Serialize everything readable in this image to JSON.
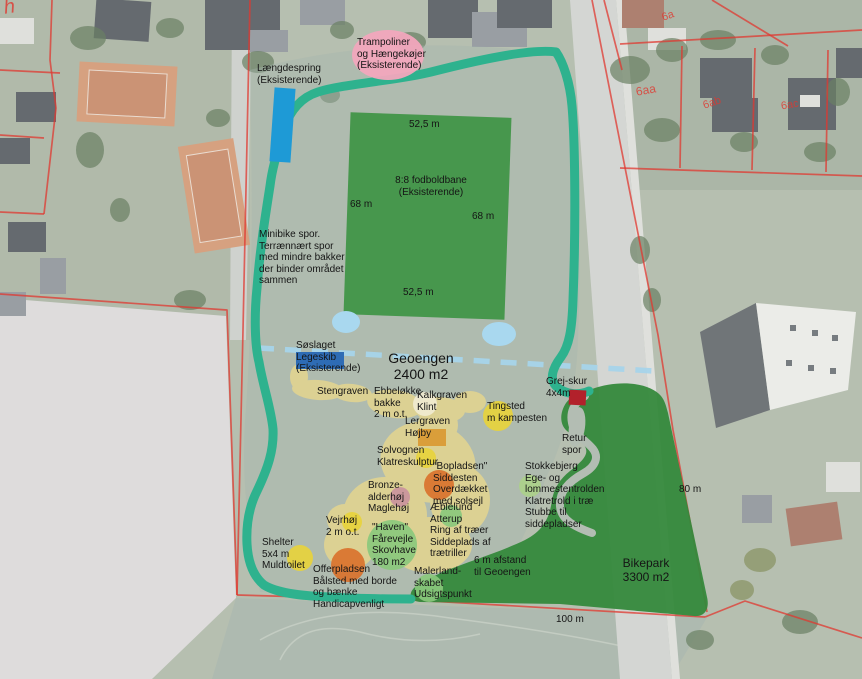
{
  "map_title": "Geoengen site plan (aerial overlay)",
  "colors": {
    "path_teal": "#2eb28e",
    "dashed_blue": "#a6d4ea",
    "sand_yellow": "#e5d58f",
    "pond_blue": "#a9d8ef",
    "field_green": "#3f9446",
    "bikepark_green": "#35893c",
    "circle_yellow": "#e7d33c",
    "circle_orange": "#d9722c",
    "circle_green": "#8ac87c",
    "circle_lightgreen": "#abd08a",
    "circle_pink": "#c9929c",
    "rect_orange": "#d99b35",
    "blue_light": "#1e9ad6",
    "blue_dark": "#2e6cb5",
    "blob_pink": "#f2a6bd",
    "shed_red": "#b2212b",
    "cadastral_red": "#e03830",
    "label_black": "#151515"
  },
  "map_labels": [
    {
      "name": "laengdespring",
      "text": "Længdespring\n(Eksisterende)",
      "x": 257,
      "y": 63
    },
    {
      "name": "trampoliner",
      "text": "Trampoliner\nog Hængekøjer\n(Eksisterende)",
      "x": 357,
      "y": 37
    },
    {
      "name": "field-width-top",
      "text": "52,5 m",
      "x": 409,
      "y": 119
    },
    {
      "name": "field-name",
      "text": "8:8 fodboldbane\n(Eksisterende)",
      "x": 431,
      "y": 175,
      "align": "center"
    },
    {
      "name": "field-side-left",
      "text": "68 m",
      "x": 350,
      "y": 199
    },
    {
      "name": "field-side-right",
      "text": "68 m",
      "x": 472,
      "y": 211
    },
    {
      "name": "field-width-bottom",
      "text": "52,5 m",
      "x": 403,
      "y": 287
    },
    {
      "name": "minibike",
      "text": "Minibike spor.\nTerrænnært spor\nmed mindre bakker\nder binder området\nsammen",
      "x": 259,
      "y": 229
    },
    {
      "name": "soeslaget",
      "text": "Søslaget\nLegeskib\n(Eksisterende)",
      "x": 296,
      "y": 340
    },
    {
      "name": "geoengen",
      "text": "Geoengen\n2400 m2",
      "x": 421,
      "y": 350,
      "size": 14,
      "align": "center"
    },
    {
      "name": "stengraven",
      "text": "Stengraven",
      "x": 317,
      "y": 386
    },
    {
      "name": "ebbeloekke",
      "text": "Ebbeløkke\nbakke\n2 m o.t.",
      "x": 374,
      "y": 386
    },
    {
      "name": "kalkgraven",
      "text": "Kalkgraven\nKlint",
      "x": 417,
      "y": 390
    },
    {
      "name": "tingsted",
      "text": "Tingsted\nm kampesten",
      "x": 487,
      "y": 401
    },
    {
      "name": "grejskur",
      "text": "Grej-skur\n4x4m",
      "x": 546,
      "y": 376
    },
    {
      "name": "lergraven",
      "text": "Lergraven\nHøjby",
      "x": 405,
      "y": 416
    },
    {
      "name": "retur-spor",
      "text": "Retur\nspor",
      "x": 562,
      "y": 433
    },
    {
      "name": "solvognen",
      "text": "Solvognen\nKlatreskulptur",
      "x": 377,
      "y": 445
    },
    {
      "name": "bopladsen",
      "text": "\"Bopladsen\"\nSiddesten\nOverdækket\nmed solsejl",
      "x": 433,
      "y": 461
    },
    {
      "name": "stokkebjerg",
      "text": "Stokkebjerg\nEge- og\nlommestentrolden\nKlatretrold i træ\nStubbe til\nsiddepladser",
      "x": 525,
      "y": 461
    },
    {
      "name": "bronzealderhoej",
      "text": "Bronze-\nalderhøj\nMaglehøj",
      "x": 368,
      "y": 480
    },
    {
      "name": "aeblelund",
      "text": "Æblelund\nAtterup\nRing af træer\nSiddeplads af\ntrætriller",
      "x": 430,
      "y": 502
    },
    {
      "name": "vejrhoej",
      "text": "Vejrhøj\n2 m o.t.",
      "x": 326,
      "y": 515
    },
    {
      "name": "haven",
      "text": "\"Haven\"\nFårevejle\nSkovhave\n180 m2",
      "x": 372,
      "y": 522
    },
    {
      "name": "shelter",
      "text": "Shelter\n5x4 m\nMuldtoilet",
      "x": 262,
      "y": 537
    },
    {
      "name": "offerpladsen",
      "text": "Offerpladsen\nBålsted med borde\nog bænke\nHandicapvenligt",
      "x": 313,
      "y": 564
    },
    {
      "name": "malerlandskabet",
      "text": "Malerland-\nskabet\nUdsigtspunkt",
      "x": 414,
      "y": 566
    },
    {
      "name": "afstand-geoengen",
      "text": "6 m afstand\ntil Geoengen",
      "x": 474,
      "y": 555
    },
    {
      "name": "bikepark",
      "text": "Bikepark\n3300 m2",
      "x": 646,
      "y": 557,
      "size": 12,
      "align": "center"
    },
    {
      "name": "dim-80m",
      "text": "80 m",
      "x": 679,
      "y": 484
    },
    {
      "name": "dim-100m",
      "text": "100 m",
      "x": 556,
      "y": 614
    },
    {
      "name": "parcel-h",
      "text": "h",
      "x": 4,
      "y": -4,
      "size": 20,
      "color": "red",
      "rotate": -8,
      "italic": true
    },
    {
      "name": "parcel-6a",
      "text": "6a",
      "x": 662,
      "y": 10,
      "size": 11,
      "color": "red",
      "rotate": -20
    },
    {
      "name": "parcel-6aa",
      "text": "6aa",
      "x": 636,
      "y": 84,
      "size": 12,
      "color": "red",
      "rotate": -10
    },
    {
      "name": "parcel-6ab",
      "text": "6ab",
      "x": 703,
      "y": 97,
      "size": 11,
      "color": "red",
      "rotate": -18
    },
    {
      "name": "parcel-6ac",
      "text": "6ac",
      "x": 781,
      "y": 99,
      "size": 11,
      "color": "red",
      "rotate": -10
    }
  ]
}
